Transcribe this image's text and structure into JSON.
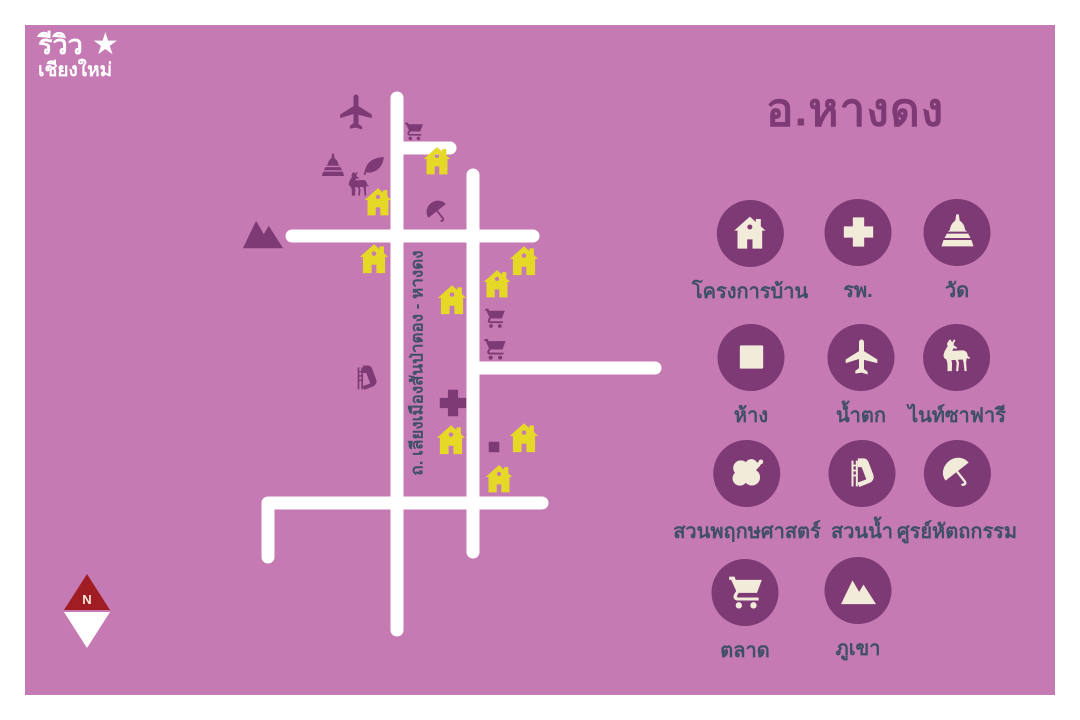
{
  "title": "อ.หางดง",
  "logo": {
    "line1": "รีวิว",
    "line2": "เชียงใหม่",
    "star_glyph": "★"
  },
  "compass": {
    "label": "N"
  },
  "legend": {
    "items": [
      {
        "icon": "house",
        "label": "โครงการบ้าน"
      },
      {
        "icon": "cross",
        "label": "รพ."
      },
      {
        "icon": "temple",
        "label": "วัด"
      },
      {
        "icon": "square",
        "label": "ห้าง"
      },
      {
        "icon": "airplane",
        "label": "น้ำตก"
      },
      {
        "icon": "deer",
        "label": "ไนท์ซาฟารี"
      },
      {
        "icon": "flower",
        "label": "สวนพฤกษศาสตร์"
      },
      {
        "icon": "slide",
        "label": "สวนน้ำ"
      },
      {
        "icon": "umbrella",
        "label": "ศูรย์หัตถกรรม"
      },
      {
        "icon": "cart",
        "label": "ตลาด"
      },
      {
        "icon": "mountain",
        "label": "ภูเขา"
      }
    ]
  },
  "map": {
    "road_label": "ถ. เลียงเมืองสันป่าตอง - หางดง",
    "roads": [
      {
        "points": [
          [
            397,
            98
          ],
          [
            397,
            630
          ]
        ]
      },
      {
        "points": [
          [
            397,
            148
          ],
          [
            450,
            148
          ]
        ]
      },
      {
        "points": [
          [
            473,
            175
          ],
          [
            473,
            552
          ]
        ]
      },
      {
        "points": [
          [
            292,
            236
          ],
          [
            533,
            236
          ]
        ]
      },
      {
        "points": [
          [
            473,
            368
          ],
          [
            655,
            368
          ]
        ]
      },
      {
        "points": [
          [
            268,
            557
          ],
          [
            268,
            503
          ],
          [
            542,
            503
          ]
        ]
      }
    ],
    "markers": [
      {
        "type": "airplane",
        "x": 356,
        "y": 112,
        "s": 40,
        "color": "icon_purple"
      },
      {
        "type": "cart",
        "x": 414,
        "y": 131,
        "s": 22,
        "color": "icon_purple"
      },
      {
        "type": "temple",
        "x": 333,
        "y": 166,
        "s": 28,
        "color": "icon_purple"
      },
      {
        "type": "leaf",
        "x": 374,
        "y": 167,
        "s": 28,
        "color": "icon_purple"
      },
      {
        "type": "deer",
        "x": 359,
        "y": 185,
        "s": 30,
        "color": "icon_purple"
      },
      {
        "type": "house",
        "x": 437,
        "y": 161,
        "s": 34,
        "color": "house_yellow"
      },
      {
        "type": "house",
        "x": 378,
        "y": 202,
        "s": 34,
        "color": "house_yellow"
      },
      {
        "type": "umbrella",
        "x": 437,
        "y": 212,
        "s": 30,
        "color": "icon_purple"
      },
      {
        "type": "mountain",
        "x": 263,
        "y": 232,
        "s": 46,
        "color": "icon_purple"
      },
      {
        "type": "house",
        "x": 374,
        "y": 259,
        "s": 36,
        "color": "house_yellow"
      },
      {
        "type": "house",
        "x": 524,
        "y": 261,
        "s": 36,
        "color": "house_yellow"
      },
      {
        "type": "house",
        "x": 497,
        "y": 284,
        "s": 34,
        "color": "house_yellow"
      },
      {
        "type": "house",
        "x": 452,
        "y": 300,
        "s": 36,
        "color": "house_yellow"
      },
      {
        "type": "cart",
        "x": 495,
        "y": 318,
        "s": 24,
        "color": "icon_purple"
      },
      {
        "type": "cart",
        "x": 495,
        "y": 349,
        "s": 26,
        "color": "icon_purple"
      },
      {
        "type": "slide",
        "x": 367,
        "y": 378,
        "s": 34,
        "color": "icon_purple"
      },
      {
        "type": "cross",
        "x": 453,
        "y": 403,
        "s": 36,
        "color": "icon_purple"
      },
      {
        "type": "house",
        "x": 451,
        "y": 440,
        "s": 36,
        "color": "house_yellow"
      },
      {
        "type": "square",
        "x": 494,
        "y": 447,
        "s": 18,
        "color": "icon_purple"
      },
      {
        "type": "house",
        "x": 524,
        "y": 438,
        "s": 36,
        "color": "house_yellow"
      },
      {
        "type": "house",
        "x": 499,
        "y": 479,
        "s": 34,
        "color": "house_yellow"
      }
    ]
  },
  "colors": {
    "frame_white": "#ffffff",
    "canvas_bg": "#c57ab3",
    "icon_purple": "#7e3a74",
    "cream": "#f2ebd9",
    "house_yellow": "#e6d826",
    "label_navy": "#3e4f66",
    "road_white": "#ffffff",
    "compass_red": "#a01d23",
    "logo_white": "#ffffff"
  }
}
